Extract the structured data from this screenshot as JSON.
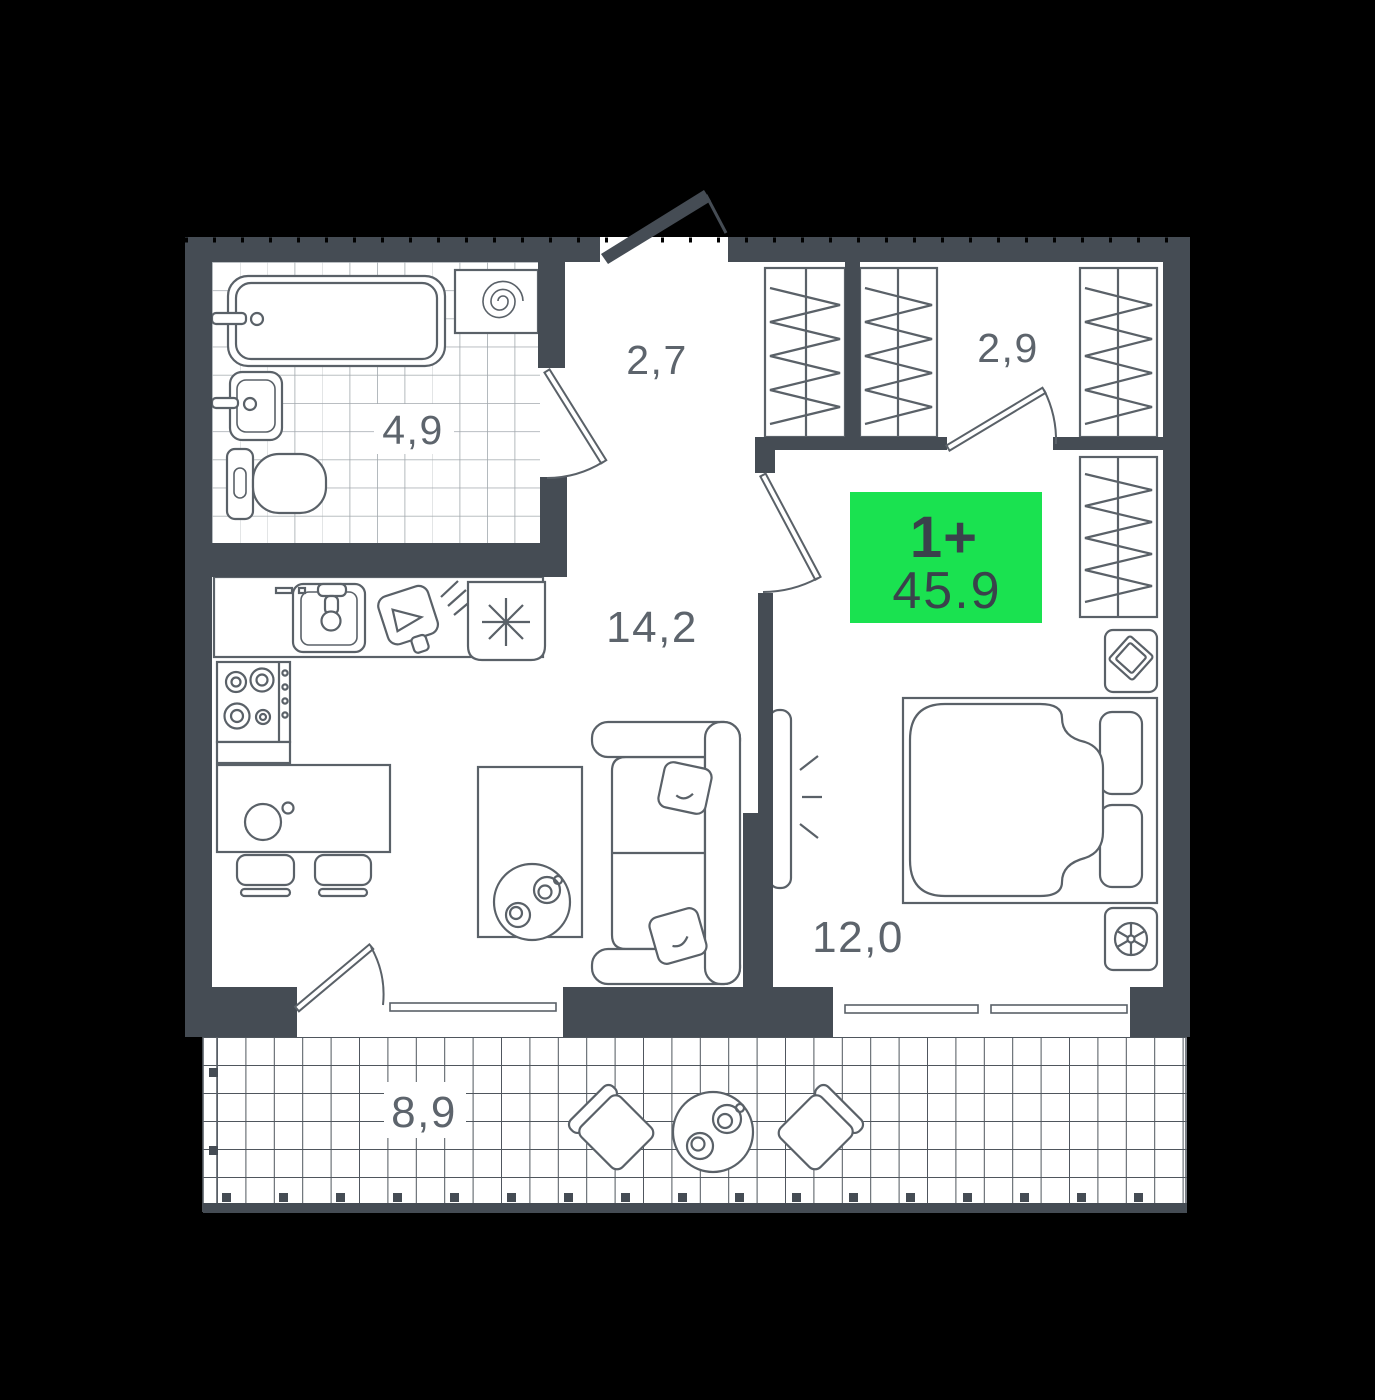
{
  "floorplan": {
    "badge": {
      "type_label": "1+",
      "total_area": "45.9"
    },
    "rooms": [
      {
        "name": "bathroom",
        "area_label": "4,9"
      },
      {
        "name": "hallway",
        "area_label": "2,7"
      },
      {
        "name": "wardrobe",
        "area_label": "2,9"
      },
      {
        "name": "kitchen-living-room",
        "area_label": "14,2"
      },
      {
        "name": "bedroom",
        "area_label": "12,0"
      },
      {
        "name": "balcony",
        "area_label": "8,9"
      }
    ],
    "colors": {
      "background": "#000000",
      "wall": "#454C54",
      "floor": "#FFFFFF",
      "furniture_outline": "#5A6168",
      "label_text": "#5D646C",
      "badge_green": "#1AE250",
      "badge_text": "#3A414B",
      "bathroom_tile_line": "#A2A8AD",
      "balcony_tile_line": "#4F565D"
    }
  }
}
